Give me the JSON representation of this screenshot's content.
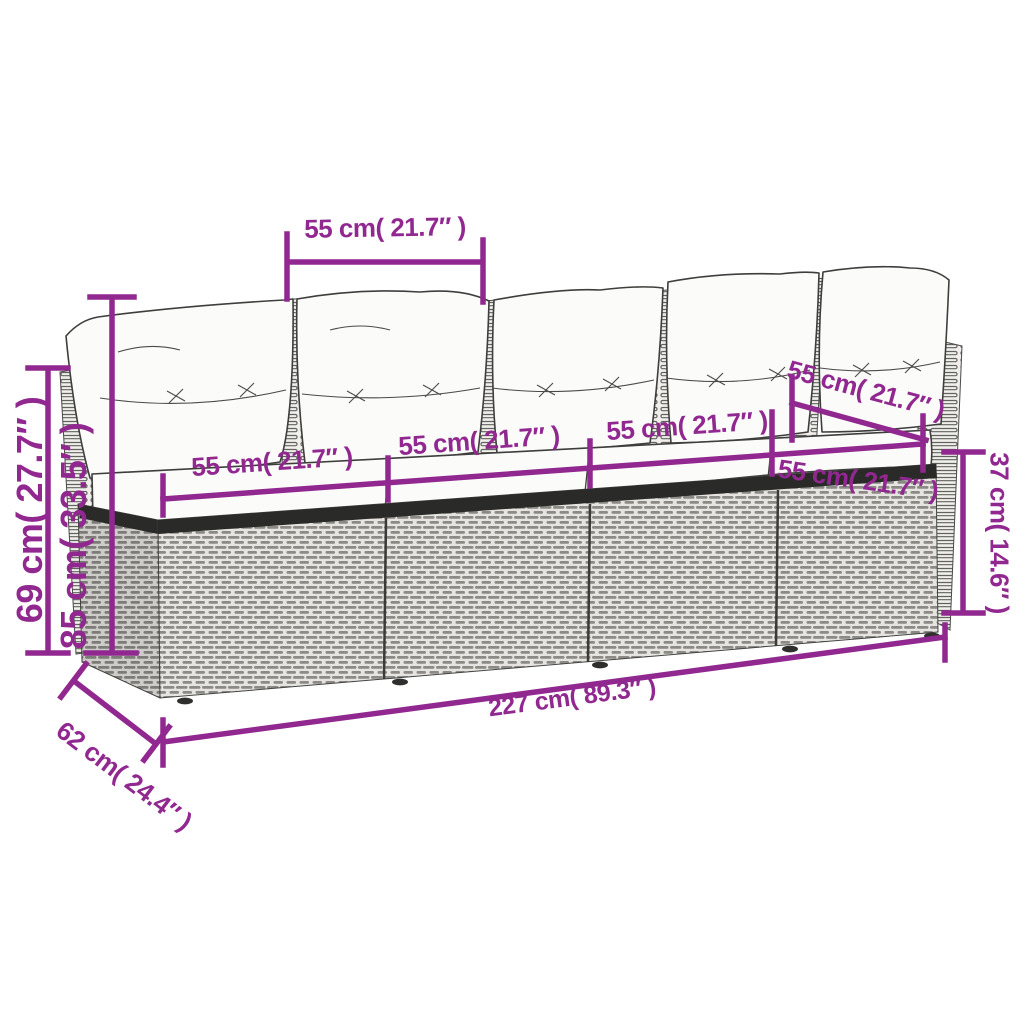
{
  "colors": {
    "dimension_accent": "#912890",
    "sketch_line": "#3e3e3c",
    "rattan_fill": "#e5e4e0",
    "rattan_dash": "#8b8a85",
    "frame_band": "#2a2a28",
    "cushion_fill": "#fbfbf9",
    "background": "#ffffff"
  },
  "dimension_labels": {
    "back_cushion_width": "55 cm( 21.7″ )",
    "backrest_height": "69 cm( 27.7″ )",
    "total_height": "85 cm( 33.5″ )",
    "seat_width_1": "55 cm( 21.7″ )",
    "seat_width_2": "55 cm( 21.7″ )",
    "seat_width_3": "55 cm( 21.7″ )",
    "seat_width_4_upper": "55 cm( 21.7″ )",
    "seat_width_4_lower": "55 cm( 21.7″ )",
    "base_height": "37 cm( 14.6″ )",
    "total_width": "227 cm( 89.3″ )",
    "total_depth": "62 cm( 24.4″ )"
  }
}
